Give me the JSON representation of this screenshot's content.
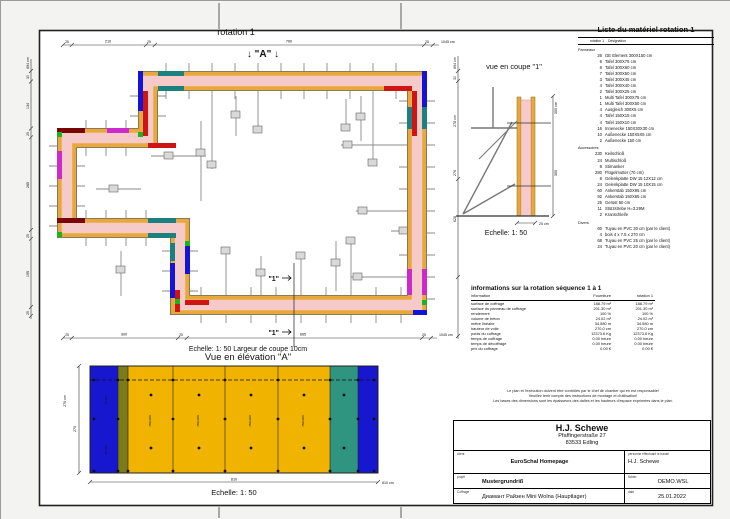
{
  "plan": {
    "title": "rotation 1",
    "marker_a": "↓ \"A\" ↓",
    "section_marker": "\"1\"",
    "dims_top": [
      "25",
      "210",
      "25",
      "760",
      "25",
      "1045 cm"
    ],
    "dims_bottom": [
      "25",
      "300",
      "25",
      "665",
      "25",
      "1045 cm"
    ],
    "dims_left": [
      "694 cm",
      "30",
      "134",
      "25",
      "265",
      "25",
      "195",
      "25"
    ],
    "dims_right": [
      "694 cm",
      "30",
      "278 cm",
      "276",
      "628"
    ]
  },
  "coupe": {
    "title": "vue en coupe \"1\"",
    "dim_height_total": "300 cm",
    "dim_height": "300",
    "dim_base": "25 cm",
    "scale": "Echelle: 1: 50"
  },
  "elevation": {
    "pretitle": "Echelle: 1: 50   Largeur de coupe 10cm",
    "title": "Vue en élévation \"A\"",
    "dim_width": "810",
    "dim_width_unit": "810 cm",
    "dim_height_total": "270 cm",
    "dim_height": "270",
    "strip_label": "50 150",
    "panel_label": "150x300",
    "scale": "Echelle: 1: 50"
  },
  "material_list": {
    "title": "Liste du matériel  rotation 1",
    "col_qty": "rotation 1",
    "col_name": "Désignation",
    "section_panneaux": "Panneaux",
    "section_accessoires": "Accessoires",
    "section_divers": "Divers",
    "panneaux": [
      {
        "qty": "26",
        "name": "GE Element 300X150 cm"
      },
      {
        "qty": "8",
        "name": "Tafel 300X75 cm"
      },
      {
        "qty": "8",
        "name": "Tafel 300X60 cm"
      },
      {
        "qty": "7",
        "name": "Tafel 300X50 cm"
      },
      {
        "qty": "3",
        "name": "Tafel 300X45 cm"
      },
      {
        "qty": "4",
        "name": "Tafel 300X40 cm"
      },
      {
        "qty": "2",
        "name": "Tafel 300X25 cm"
      },
      {
        "qty": "1",
        "name": "Multi Tafel 300X75 cm"
      },
      {
        "qty": "1",
        "name": "Multi Tafel 300X50 cm"
      },
      {
        "qty": "4",
        "name": "Ausgleich 300X5 cm"
      },
      {
        "qty": "4",
        "name": "Tafel 150X15 cm"
      },
      {
        "qty": "4",
        "name": "Tafel 150X10 cm"
      },
      {
        "qty": "16",
        "name": "Innenecke 150X30X30 cm"
      },
      {
        "qty": "10",
        "name": "Außenecke 150X5X5 cm"
      },
      {
        "qty": "2",
        "name": "Außenecke 150 cm"
      }
    ],
    "accessoires": [
      {
        "qty": "230",
        "name": "Keilschloß"
      },
      {
        "qty": "24",
        "name": "Multischloß"
      },
      {
        "qty": "8",
        "name": "Stirnanker"
      },
      {
        "qty": "280",
        "name": "Flügelmutter (70 cm)"
      },
      {
        "qty": "8",
        "name": "Gelenkplatte DW 15 12X12 cm"
      },
      {
        "qty": "24",
        "name": "Gelenkplatte DW 15 10X15 cm"
      },
      {
        "qty": "60",
        "name": "Ankerstab 150X95 cm"
      },
      {
        "qty": "92",
        "name": "Ankerstab 150X65 cm"
      },
      {
        "qty": "25",
        "name": "Gerüst 50 cm"
      },
      {
        "qty": "11",
        "name": "Stützstrebe H=3.29M"
      },
      {
        "qty": "2",
        "name": "Kranschleife"
      }
    ],
    "divers": [
      {
        "qty": "60",
        "name": "Tuyau en PVC 30 cm (par le client)"
      },
      {
        "qty": "4",
        "name": "bois 4 x 7.5 x 270 cm"
      },
      {
        "qty": "68",
        "name": "Tuyau en PVC 25 cm (par le client)"
      },
      {
        "qty": "24",
        "name": "Tuyau en PVC 20 cm (par le client)"
      }
    ]
  },
  "info_table": {
    "title": "informations sur la rotation  séquence 1 à 1",
    "col_info": "information",
    "col_fourniture": "Fourniture",
    "col_rotation": "rotation 1",
    "rows": [
      {
        "label": "surface de coffrage",
        "fourniture": "188.79 m²",
        "rotation": "188.79 m²"
      },
      {
        "label": "surface du panneau de coffrage",
        "fourniture": "201.30 m²",
        "rotation": "201.30 m²"
      },
      {
        "label": "rendement",
        "fourniture": "100 %",
        "rotation": "100 %"
      },
      {
        "label": "volume de béton",
        "fourniture": "24.02 m³",
        "rotation": "24.02 m³"
      },
      {
        "label": "mètre linéaire",
        "fourniture": "34.580 m",
        "rotation": "34.580 m"
      },
      {
        "label": "hauteur de voile",
        "fourniture": "270.0 cm",
        "rotation": "270.0 cm"
      },
      {
        "label": "poids du coffrage",
        "fourniture": "12373.6 Kg",
        "rotation": "12373.6 Kg"
      },
      {
        "label": "temps de coffrage",
        "fourniture": "0.00 heure",
        "rotation": "0.00 heure"
      },
      {
        "label": "temps de décoffrage",
        "fourniture": "0.00 heure",
        "rotation": "0.00 heure"
      },
      {
        "label": "prix du coffrage",
        "fourniture": "0.00 €",
        "rotation": "0.00 €"
      }
    ]
  },
  "disclaimer": {
    "line1": "Le plan et l'exécution doivent être contrôlés par le chef de chantier qui en est responsable!",
    "line2": "Veuillez tenir compte des instructions de montage et d'utilisation!",
    "line3": "Les bases des dimensions sont les épaisseurs des dalles et les hauteurs d'espace exprimées dans le plan."
  },
  "titleblock": {
    "company": "H.J. Schewe",
    "address1": "Pfaffingerstraße 27",
    "address2": "83533 Edling",
    "client_label": "client",
    "client": "EuroSchal Homepage",
    "worker_label": "personne effectuant le travail",
    "worker": "H.J. Schewe",
    "project_label": "projet",
    "project": "Mustergrundriß",
    "file_label": "fichier",
    "file": "DEMO.WSL",
    "coffrage_label": "Coffrage",
    "coffrage": "Диамант Райзен Mini Wolna (Hauptlager)",
    "date_label": "date",
    "date": "25.01.2022"
  },
  "colors": {
    "wall_fill": "#f7caca",
    "panel_yellow": "#e9a93a",
    "elevation_yellow": "#f0b400",
    "elevation_blue": "#1717cf",
    "elevation_teal": "#2f9480",
    "elevation_olive": "#7b7b17",
    "accent_blue": "#1414d6",
    "accent_red": "#cf1414",
    "accent_green": "#1db31d",
    "accent_magenta": "#cc2acc",
    "accent_teal": "#1d8080",
    "accent_darkred": "#7a0505",
    "tie_gray": "#8a8a8a"
  }
}
